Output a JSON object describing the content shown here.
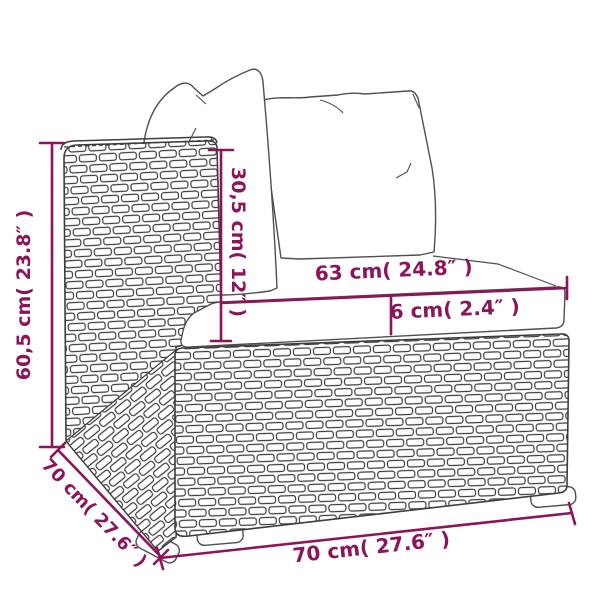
{
  "diagram": {
    "type": "furniture-dimension-diagram",
    "subject": "poly-rattan sofa section with back pillows and seat cushion",
    "colors": {
      "dimension_accent": "#8d1458",
      "line_art": "#3d3d3d",
      "background": "#ffffff"
    },
    "labels": {
      "overall_height": "60,5 cm( 23.8″ )",
      "backrest_height": "30,5 cm( 12″ )",
      "seat_width": "63 cm( 24.8″ )",
      "cushion_thickness": "6 cm( 2.4″ )",
      "depth": "70 cm( 27.6″ )",
      "overall_width": "70 cm( 27.6″ )"
    }
  }
}
